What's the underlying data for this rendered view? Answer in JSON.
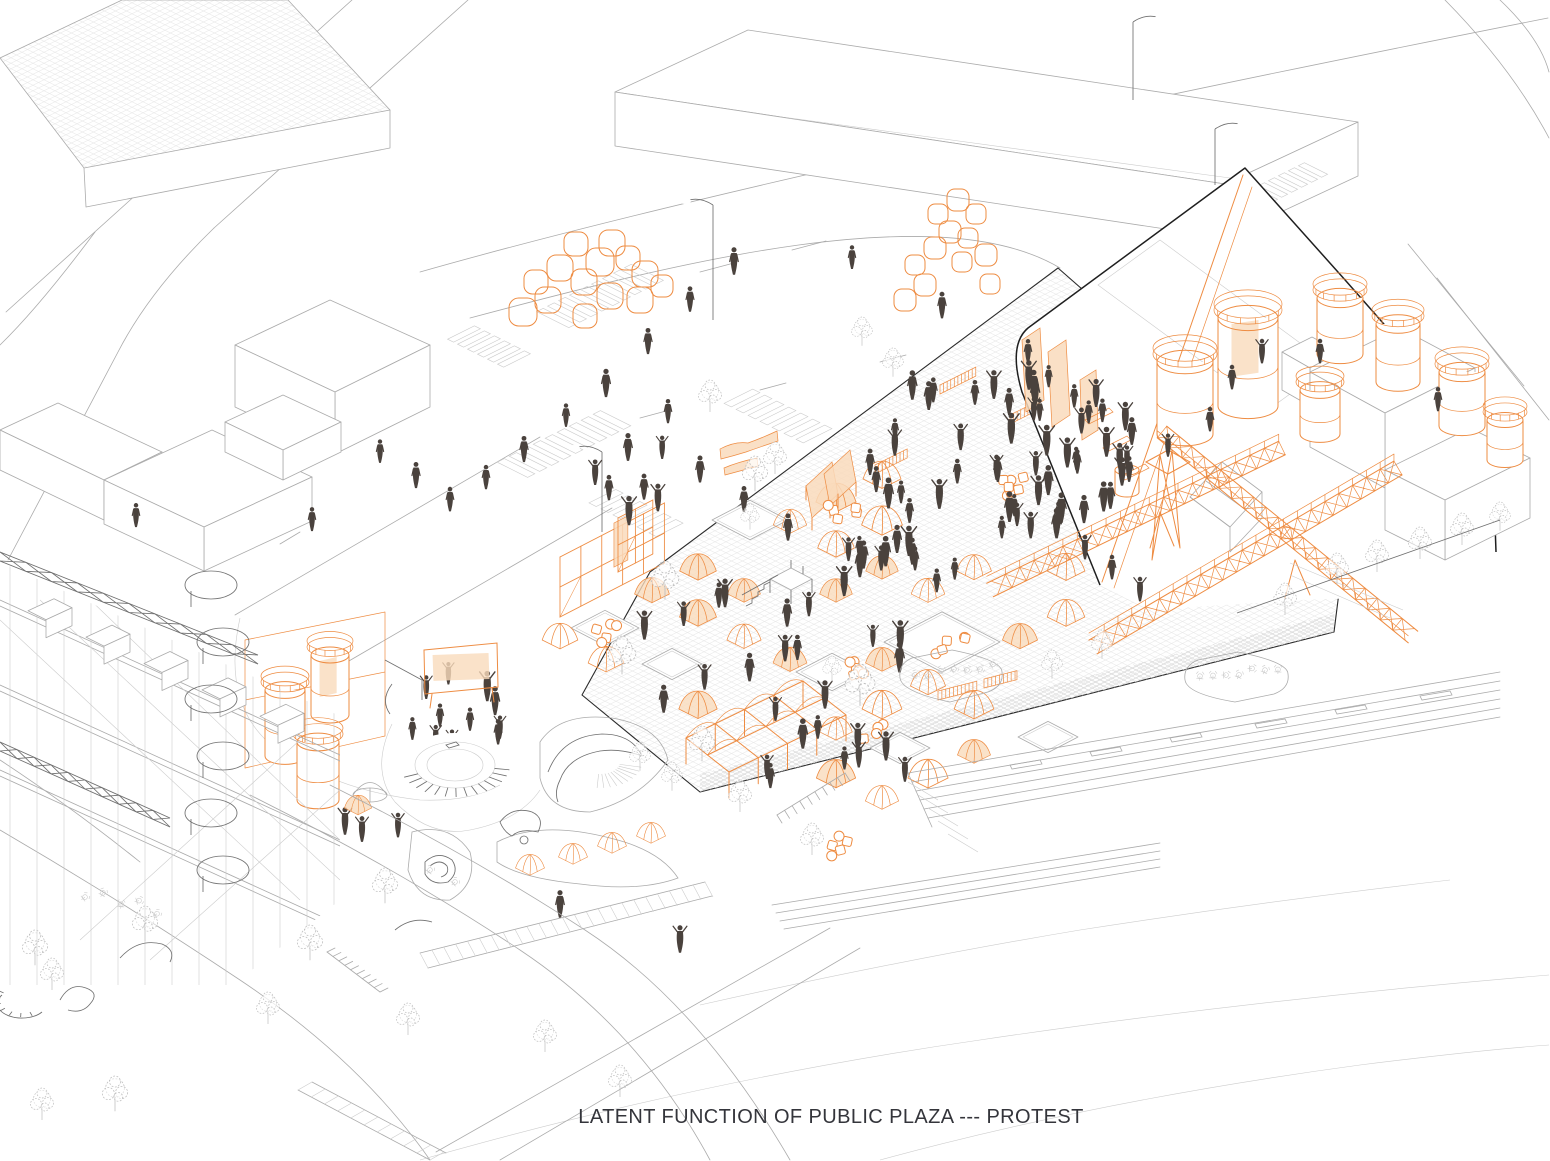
{
  "caption": {
    "text": "LATENT FUNCTION OF PUBLIC PLAZA --- PROTEST"
  },
  "palette": {
    "accent_orange": "#EE8C42",
    "accent_orange_fill": "#F9DBBC",
    "line_gray": "#ABABAB",
    "line_gray_light": "#CCCCCC",
    "line_gray_dark": "#6F6F6F",
    "outline_black": "#1F1F1F",
    "figure_dark": "#4A423D",
    "background": "#FFFFFF"
  },
  "scene": {
    "type": "axonometric architectural site drawing",
    "highlight_meaning": "orange = temporary protest / event structures",
    "elements": [
      "gridded-roof-building",
      "storefront-row",
      "street-network",
      "crosswalks",
      "street-lamps",
      "slab-building",
      "orange-balloon-clusters",
      "public-plaza-paving",
      "dome-tents",
      "canopy-pavilion",
      "scaffold-structures",
      "grandstand",
      "stage-screen",
      "banners",
      "barricades",
      "drum-props",
      "protest-crowd",
      "pedestrians",
      "factory-building",
      "rooftop-silo-tanks",
      "truss-bridges",
      "lookout-tower",
      "west-silo-cluster",
      "sunken-amphitheater",
      "landscape-mounds",
      "small-tent-row",
      "construction-frame-building",
      "spiral-ramps",
      "curved-benches",
      "cafe-seating",
      "terraced-steps",
      "promenade-boardwalk",
      "street-trees"
    ]
  }
}
